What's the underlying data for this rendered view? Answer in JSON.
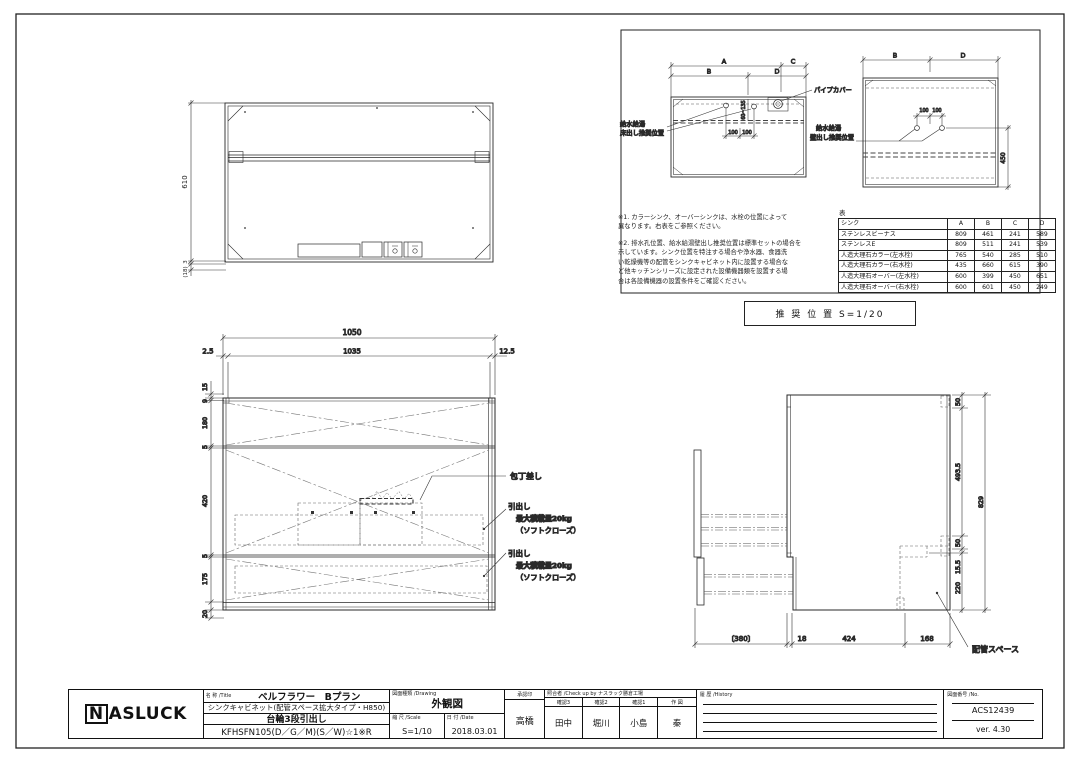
{
  "plan_view": {
    "h610": "610",
    "d3": "3",
    "d18": "(18)"
  },
  "front_view": {
    "w1050": "1050",
    "w25": "2.5",
    "w1035": "1035",
    "w125": "12.5",
    "left_dims": [
      "15",
      "9",
      "180",
      "5",
      "420",
      "5",
      "175",
      "20"
    ],
    "knife_label": "包丁差し",
    "drawer_label": "引出し",
    "drawer_load": "最大積載量20kg",
    "drawer_close": "（ソフトクローズ）"
  },
  "layout_left": {
    "a": "A",
    "b": "B",
    "c": "C",
    "d": "D",
    "pipe_cover": "パイプカバー",
    "supply1": "給水給湯",
    "supply2": "床出し推奨位置",
    "d100a": "100",
    "d100b": "100",
    "range": "60~135"
  },
  "layout_right": {
    "b": "B",
    "d": "D",
    "supply1": "給水給湯",
    "supply2": "壁出し推奨位置",
    "d100a": "100",
    "d100b": "100",
    "d450": "450"
  },
  "side_view": {
    "d380": "〔380〕",
    "d18": "18",
    "d424": "424",
    "d168": "168",
    "d50a": "50",
    "d4935": "493.5",
    "d50b": "50",
    "d155": "15.5",
    "d220": "220",
    "d829": "829",
    "pipe_space": "配管スペース"
  },
  "notes": {
    "note1": "※1. カラーシンク、オーバーシンクは、水栓の位置によって\n異なります。右表をご参照ください。",
    "note2": "※2. 排水孔位置、給水給湯壁出し推奨位置は標準セットの場合を\n示しています。シンク位置を特注する場合や浄水器、食器洗\nい乾燥機等の配管をシンクキャビネット内に設置する場合な\nど他キッチンシリーズに設定された設備機器類を設置する場\n合は各設備機器の設置条件をご確認ください。"
  },
  "sink_table": {
    "caption": "表",
    "headers": [
      "シンク",
      "A",
      "B",
      "C",
      "D"
    ],
    "rows": [
      [
        "ステンレスビーナス",
        "809",
        "461",
        "241",
        "589"
      ],
      [
        "ステンレスE",
        "809",
        "511",
        "241",
        "539"
      ],
      [
        "人造大理石カラー(左水栓)",
        "765",
        "540",
        "285",
        "510"
      ],
      [
        "人造大理石カラー(右水栓)",
        "435",
        "660",
        "615",
        "390"
      ],
      [
        "人造大理石オーバー(左水栓)",
        "600",
        "399",
        "450",
        "651"
      ],
      [
        "人造大理石オーバー(右水栓)",
        "600",
        "601",
        "450",
        "249"
      ]
    ]
  },
  "recommend_box": "推 奨 位 置  S=1/20",
  "title_block": {
    "logo": "ASLUCK",
    "logo_n": "N",
    "name_label": "名 称 /Title",
    "title_line1": "ベルフラワー　Bプラン",
    "title_line2": "シンクキャビネット(配管スペース拡大タイプ・H850)",
    "title_line3": "台輪3段引出し",
    "title_line4": "KFHSFN105(D／G／M)(S／W)☆1※R",
    "drawing_label": "図面種類 /Drawing",
    "drawing_type": "外観図",
    "scale_label": "縮 尺 /Scale",
    "scale": "S=1/10",
    "date_label": "日 付 /Date",
    "date": "2018.03.01",
    "approval_label": "承認印",
    "approval": "高橋",
    "check_label": "照合者 /Check up by ナスラック勝倉工場",
    "check_cols": [
      {
        "label": "確認3",
        "value": "田中"
      },
      {
        "label": "確認2",
        "value": "堀川"
      },
      {
        "label": "確認1",
        "value": "小島"
      },
      {
        "label": "作 図",
        "value": "秦"
      }
    ],
    "history_label": "履 歴 /History",
    "number_label": "図面番号 /No.",
    "number": "ACS12439",
    "version": "ver. 4.30"
  }
}
